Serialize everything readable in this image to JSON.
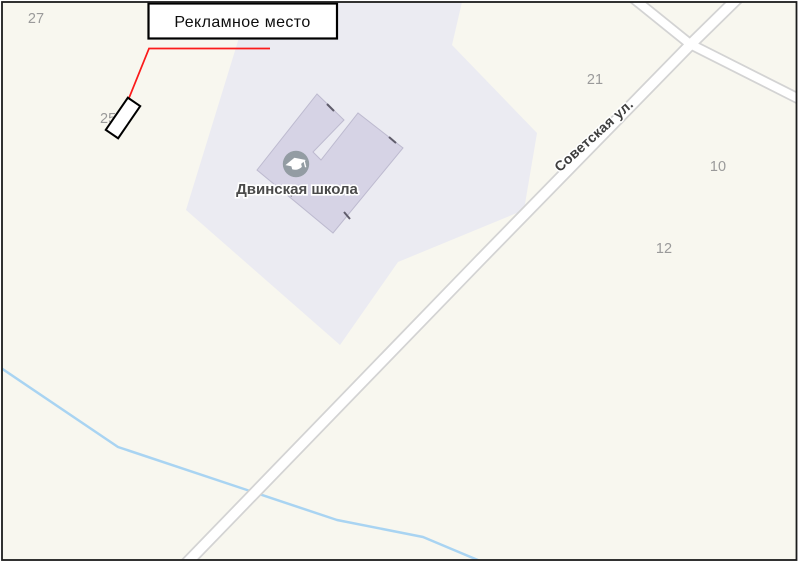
{
  "colors": {
    "map_background": "#f8f7ef",
    "school_grounds": "#ebebf2",
    "building": "#d6d3e5",
    "road_fill": "#ffffff",
    "road_casing": "#d3d3d3",
    "river": "#a9d4f2",
    "callout": "#fb1b1b",
    "school_icon_bg": "#939ca3",
    "frame_border": "#1c1c1c"
  },
  "callout": {
    "label": "Рекламное место"
  },
  "poi": {
    "school_name": "Двинская школа",
    "icon": "graduation-cap"
  },
  "street": {
    "name": "Советская ул."
  },
  "house_numbers": {
    "n27": "27",
    "n21": "21",
    "n10": "10",
    "n12": "12",
    "n25": "25"
  }
}
